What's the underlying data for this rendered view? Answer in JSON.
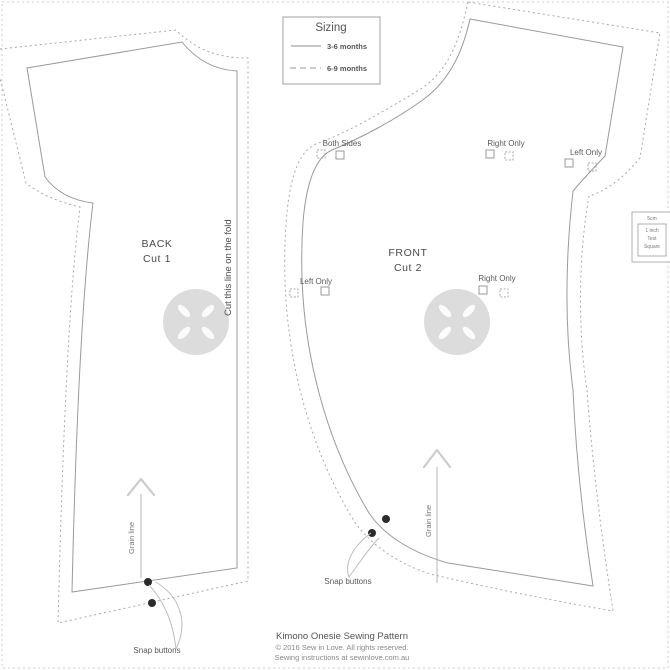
{
  "legend": {
    "title": "Sizing",
    "solid_label": "3-6 months",
    "dashed_label": "6-9 months"
  },
  "back_piece": {
    "name": "BACK",
    "cut": "Cut 1",
    "fold_note": "Cut this line on the fold",
    "grain": "Grain line",
    "snaps": "Snap buttons"
  },
  "front_piece": {
    "name": "FRONT",
    "cut": "Cut 2",
    "grain": "Grain line",
    "snaps": "Snap buttons"
  },
  "markers": {
    "both_sides": "Both Sides",
    "right_only_top": "Right Only",
    "left_only_top": "Left Only",
    "left_only_mid": "Left Only",
    "right_only_mid": "Right Only"
  },
  "test_square": {
    "cm": "5cm",
    "inch": "1 inch",
    "word1": "Test",
    "word2": "Square"
  },
  "footer": {
    "title": "Kimono Onesie Sewing Pattern",
    "copyright": "© 2016 Sew in Love. All rights reserved.",
    "instructions": "Sewing instructions at sewinlove.com.au"
  },
  "colors": {
    "outline": "#9a9a9a",
    "text": "#555555",
    "snap_dot": "#2b2b2b",
    "watermark": "#dcdcdc"
  }
}
